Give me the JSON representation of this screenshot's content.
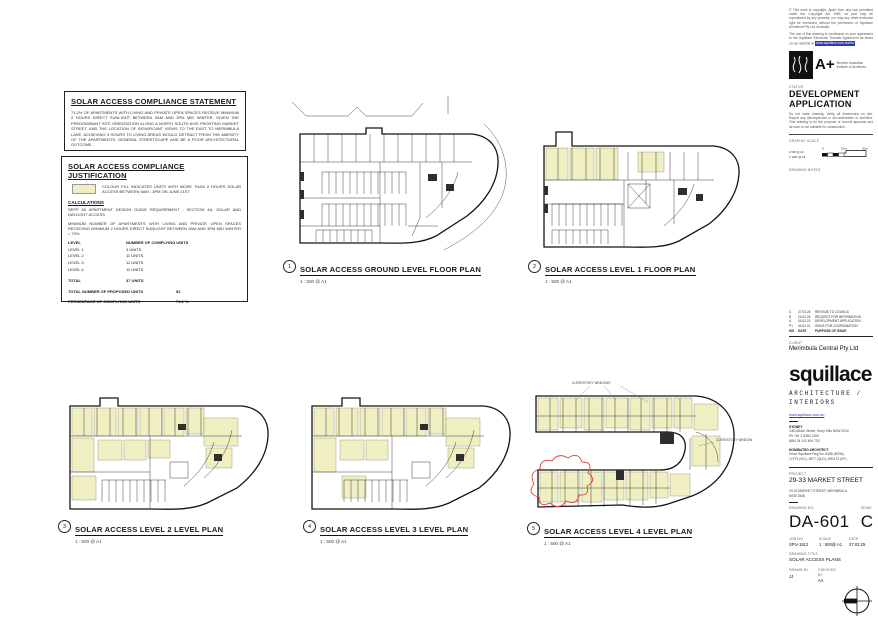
{
  "colors": {
    "unit_fill": "#EFEFC2",
    "revision_cloud": "#E04040",
    "link_blue": "#2B3BB5"
  },
  "statement_box": {
    "title": "SOLAR ACCESS COMPLIANCE STATEMENT",
    "body": "71.2% OF APARTMENTS WITH LIVING AND PRIVATE OPEN SPACES RECEIVE MINIMUM 2 HOURS DIRECT SUNLIGHT BETWEEN 9AM AND 3PM MID WINTER. GIVEN THE PREDOMINANT SITE ORIENTATION ALONG A NORTH SOUTH AXIS FRONTING MARKET STREET, AND THE LOCATION OF SIGNIFICANT VIEWS TO THE EAST TO MERIMBULA LAKE, ACHIEVING 3 HOURS TO LIVING AREAS WOULD DETRACT FROM THE AMENITY OF THE APARTMENTS, GENERAL STREETSCAPE AND BE A POOR ARCHITECTURAL OUTCOME."
  },
  "justification_box": {
    "title": "SOLAR ACCESS COMPLIANCE JUSTIFICATION",
    "legend_text": "COLOUR FILL INDICATES UNITS WITH MORE THAN 2 HOURS SOLAR ACCESS BETWEEN 9AM - 3PM ON JUNE 21ST",
    "calculations_heading": "CALCULATIONS",
    "para1": "SEPP 65 APARTMENT DESIGN GUIDE REQUIREMENT - SECTION 4A, SOLAR AND DAYLIGHT ACCESS",
    "para2": "MINIMUM NUMBER OF APARTMENTS WITH LIVING AND PRIVATE OPEN SPACES RECEIVING MINIMUM 2 HOURS DIRECT SUNLIGHT BETWEEN 9AM AND 3PM MID WINTER = 70%",
    "table": {
      "header_level": "LEVEL",
      "header_units": "NUMBER OF COMPLYING UNITS",
      "rows": [
        [
          "LEVEL 1",
          "4 UNITS"
        ],
        [
          "LEVEL 2",
          "11 UNITS"
        ],
        [
          "LEVEL 3",
          "11 UNITS"
        ],
        [
          "LEVEL 4",
          "11 UNITS"
        ]
      ],
      "total_label": "TOTAL",
      "total_value": "37 UNITS",
      "proposed_label": "TOTAL NUMBER OF PROPOSED UNITS",
      "proposed_value": "52",
      "percentage_label": "PERCENTAGE OF COMPLYING UNITS",
      "percentage_value": "71.2 %"
    }
  },
  "plans": [
    {
      "number": "1",
      "title": "SOLAR ACCESS GROUND LEVEL FLOOR PLAN",
      "scale": "1 : 500 @ A1"
    },
    {
      "number": "2",
      "title": "SOLAR ACCESS LEVEL 1 FLOOR PLAN",
      "scale": "1 : 500 @ A1"
    },
    {
      "number": "3",
      "title": "SOLAR ACCESS LEVEL 2 LEVEL PLAN",
      "scale": "1 : 500 @ A1"
    },
    {
      "number": "4",
      "title": "SOLAR ACCESS LEVEL 3 LEVEL PLAN",
      "scale": "1 : 500 @ A1"
    },
    {
      "number": "5",
      "title": "SOLAR ACCESS LEVEL 4 LEVEL PLAN",
      "scale": "1 : 500 @ A1"
    }
  ],
  "annotations": {
    "clerestory": "CLERESTORY WINDOWS"
  },
  "titleblock": {
    "copyright": "© This work is copyright. Apart from any use permitted under the Copyright Act 1968, no part may be reproduced by any process, nor may any other exclusive right be exercised, without the permission of Squillace Architects Pty Ltd, Australia",
    "eta_note": "The use of this drawing is conditional on your agreement to the Squillace Electronic Transfer Agreement as found on our website at",
    "eta_link": "www.squillace.com.au/eta",
    "member_logo": "A+",
    "member_text": "Member Australian Institute of Architects",
    "status_label": "STATUS",
    "status_value": "DEVELOPMENT APPLICATION",
    "disclaimer": "Do not scale drawing. Verify all dimensions on site. Report any discrepancies in documentation to architect. This drawing is for the purpose of council approval and as such is not suitable for construction.",
    "graphic_scale_label": "GRAPHIC SCALE",
    "scale_row1": "1:500 @ A1",
    "scale_row2": "1:1000 @ A3",
    "scale_0": "0",
    "scale_10": "10m",
    "scale_20": "20m",
    "drawing_notes_label": "DRAWING NOTES",
    "rev_header": {
      "iss": "ISS",
      "date": "DATE",
      "purpose": "PURPOSE OF ISSUE"
    },
    "revisions": [
      {
        "iss": "C",
        "date": "27.03.25",
        "purpose": "REISSUE TO COUNCIL"
      },
      {
        "iss": "B",
        "date": "24.04.24",
        "purpose": "REQUEST FOR INFORMATION"
      },
      {
        "iss": "A",
        "date": "04.03.23",
        "purpose": "DEVELOPMENT APPLICATION"
      },
      {
        "iss": "P1",
        "date": "04.02.21",
        "purpose": "ISSUE FOR COORDINATION"
      }
    ],
    "client_label": "CLIENT",
    "client_name": "Merimbula Central Pty Ltd",
    "logo": "squillace",
    "logo_sub1": "ARCHITECTURE /",
    "logo_sub2": "INTERIORS",
    "website": "www.squillace.com.au",
    "office_city": "SYDNEY",
    "office_lines": [
      "1/80 Albion Street, Surry Hills NSW 2010",
      "Ph +61 2 8354 1300",
      "ABN 24 102 604 703"
    ],
    "nominated_label": "NOMINATED ARCHITECT",
    "nominated_lines": [
      "Vince Squillace Reg No. 6496 (NSW),",
      "17279 (VIC), 3877 (QLD), AR1173 (NT)"
    ],
    "project_label": "PROJECT",
    "project_name": "29-33 MARKET STREET",
    "project_address1": "29-33 MARKET STREET, MERIMBULA",
    "project_address2": "NSW 2548",
    "drawing_no_label": "DRAWING NO.",
    "drawing_no": "DA-601",
    "issue_label": "ISSUE",
    "issue": "C",
    "job_no_label": "JOB NO.",
    "job_no": "SPU-1912",
    "scale_label": "SCALE",
    "scale_value": "1 : 500@ A1",
    "date_label": "DATE",
    "date_value": "27.03.25",
    "drawing_title_label": "DRAWING TITLE",
    "drawing_title": "SOLAR ACCESS PLANS",
    "drawn_by_label": "DRAWN BY",
    "drawn_by": "JJ",
    "checked_by_label": "CHECKED BY",
    "checked_by": "AA"
  }
}
